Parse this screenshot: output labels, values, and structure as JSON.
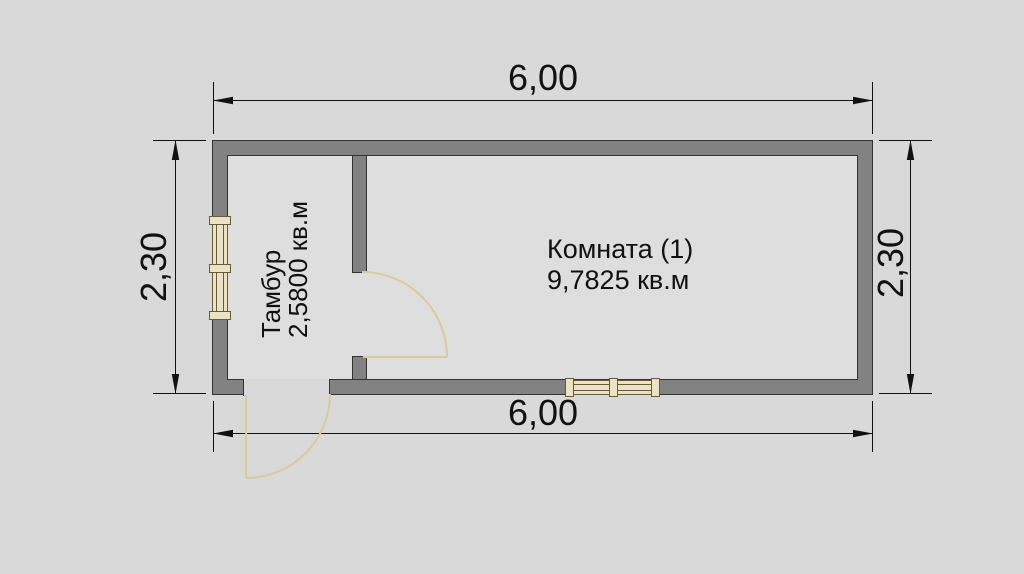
{
  "drawing": {
    "type": "floor-plan",
    "dimensions": {
      "width_top": "6,00",
      "width_bottom": "6,00",
      "height_left": "2,30",
      "height_right": "2,30"
    },
    "rooms": {
      "vestibule": {
        "name": "Тамбур",
        "area": "2,5800 кв.м"
      },
      "room1": {
        "name": "Комната (1)",
        "area": "9,7825 кв.м"
      }
    },
    "colors": {
      "background": "#d9d9d9",
      "interior": "#dedede",
      "wall_fill": "#828282",
      "wall_outline": "#333333",
      "dimension_line": "#111111",
      "door_symbol": "#d8cc9c",
      "window_fill": "#eae3c8",
      "window_outline": "#6b5b33",
      "text": "#111111"
    }
  }
}
